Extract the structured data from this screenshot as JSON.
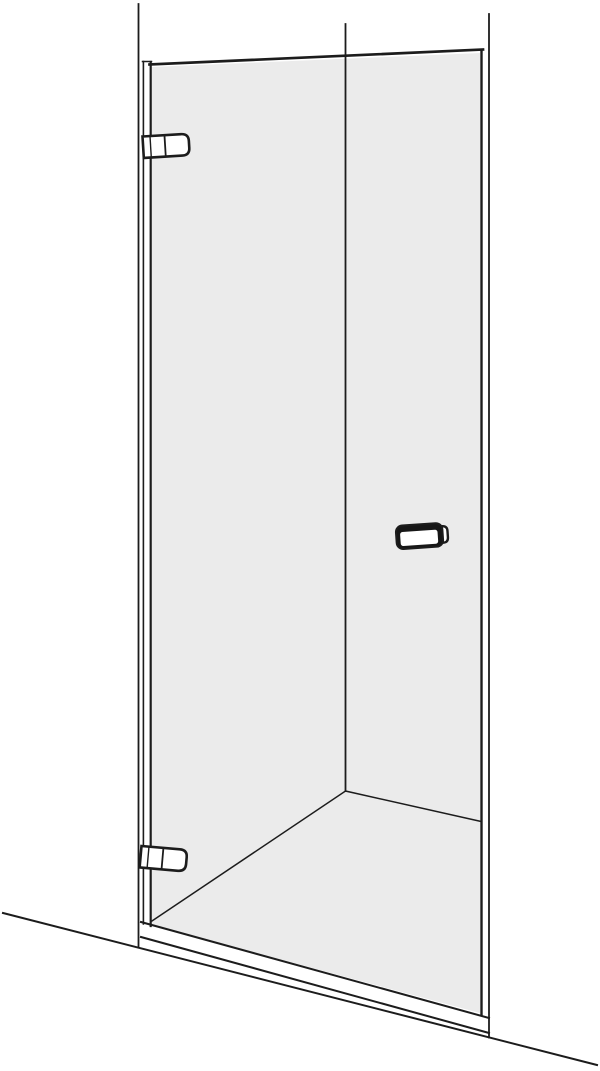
{
  "figure": {
    "kind": "technical-line-drawing",
    "subject": "hinged-glass-shower-door-perspective-view",
    "components": {
      "left_wall": "left wall edge line",
      "corner": "room corner line behind glass",
      "right_wall": "right wall edge line",
      "glass_panel": "tinted glass door panel",
      "wall_profile": "hinge-side wall mounting profile",
      "top_hinge": "upper door hinge",
      "bottom_hinge": "lower door hinge",
      "handle": "door handle knob",
      "tray": "shower tray front edge",
      "floor": "room floor line"
    }
  },
  "colors": {
    "background": "#ffffff",
    "line": "#1c1c1c",
    "glass": "#ebebeb",
    "fitting": "#ffffff",
    "handle_dark": "#161616"
  }
}
